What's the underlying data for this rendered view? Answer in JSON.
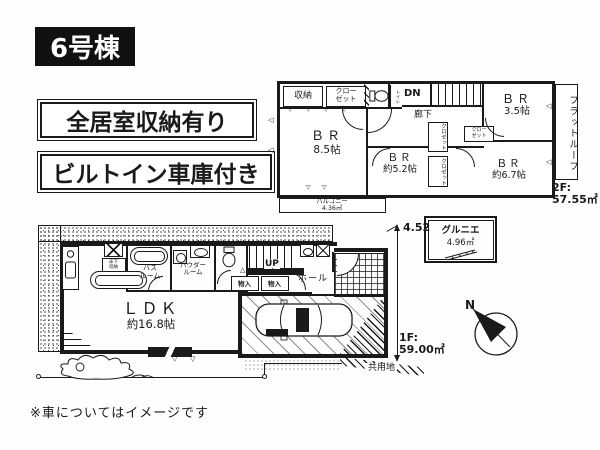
{
  "colors": {
    "ink": "#1a1a1a",
    "paper": "#ffffff"
  },
  "badges": {
    "building": "6号棟",
    "feature_storage": "全居室収納有り",
    "feature_garage": "ビルトイン車庫付き"
  },
  "note": "※車についてはイメージです",
  "compass": {
    "north": "N"
  },
  "glyphs": {
    "tri_down": "▽",
    "tri_up": "△",
    "tri_left": "◁"
  },
  "floor2": {
    "storage": "収納",
    "closet_l1": "クロー",
    "closet_l2": "ゼット",
    "toilet_v": "トイレ",
    "dn": "DN",
    "hallway": "廊下",
    "br1_name": "ＢＲ",
    "br1_size": "8.5帖",
    "br2_name": "ＢＲ",
    "br2_size": "約5.2帖",
    "br3_name": "ＢＲ",
    "br3_size": "3.5帖",
    "br4_name": "ＢＲ",
    "br4_size": "約6.7帖",
    "closet_v1": "クロゼット",
    "closet_v2": "クロゼット",
    "closet_s_l1": "クロー",
    "closet_s_l2": "ゼット",
    "balcony_name": "バルコニー",
    "balcony_size": "4.36㎡",
    "flat_roof": "フラットルーフ",
    "area_label": "2F:",
    "area_value": "57.55㎡"
  },
  "attic": {
    "name": "グルニエ",
    "size": "4.96㎡"
  },
  "floor1": {
    "ldk_name": "ＬＤＫ",
    "ldk_size": "約16.8帖",
    "bath_l1": "バス",
    "bath_l2": "ルーム",
    "powder_l1": "パウダー",
    "powder_l2": "ルーム",
    "underfloor_l1": "床下",
    "underfloor_l2": "収納",
    "up": "UP",
    "hall": "ホール",
    "storage1": "物入",
    "storage2": "物入",
    "dim": "4.52",
    "area_label": "1F:",
    "area_value": "59.00㎡",
    "common_land": "共用地"
  }
}
